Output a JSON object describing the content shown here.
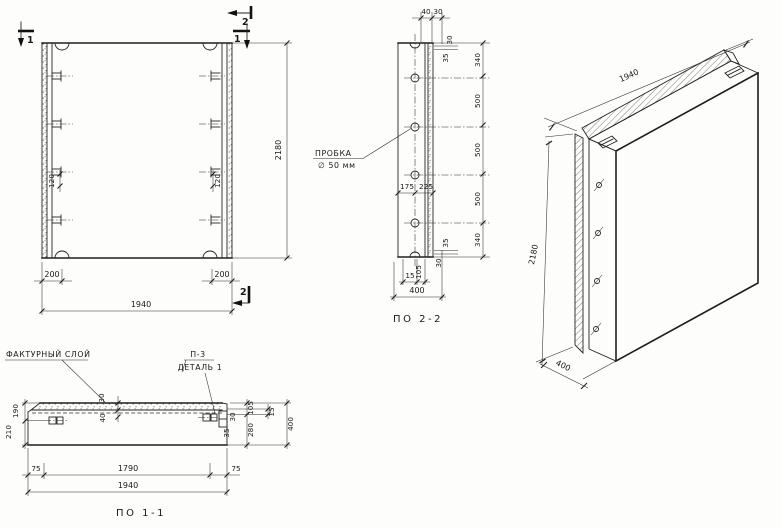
{
  "front_view": {
    "marker_1_top_left": "1",
    "marker_2_top_right": "2",
    "marker_1_top_right": "1",
    "marker_2_bottom": "2",
    "dim_anchor_left": "120",
    "dim_anchor_right": "120",
    "dim_height": "2180",
    "dim_edge_left": "200",
    "dim_edge_right": "200",
    "dim_width": "1940"
  },
  "section_2_2": {
    "caption": "ПО 2-2",
    "plug_label_line1": "ПРОБКА",
    "plug_label_line2": "∅ 50 мм",
    "dim_top_40": "40",
    "dim_top_30": "30",
    "dim_right_top_30": "30",
    "dim_right_top_35": "35",
    "chain": [
      "340",
      "500",
      "500",
      "500",
      "340"
    ],
    "dim_right_bottom_35": "35",
    "dim_right_bottom_30": "30",
    "dim_mid_left": "175",
    "dim_mid_right": "225",
    "dim_bottom_15": "15",
    "dim_bottom_105": "105",
    "dim_width": "400"
  },
  "iso_view": {
    "dim_width": "1940",
    "dim_height": "2180",
    "dim_depth": "400"
  },
  "section_1_1": {
    "caption": "ПО 1-1",
    "label_facing_layer": "ФАКТУРНЫЙ СЛОЙ",
    "label_detail_line1": "П-3",
    "label_detail_line2": "ДЕТАЛЬ 1",
    "dim_top_30": "30",
    "dim_top_40": "40",
    "dim_left_190": "190",
    "dim_left_210": "210",
    "dim_right_105": "105",
    "dim_right_15": "15",
    "dim_right_280": "280",
    "dim_right_400": "400",
    "dim_detail_30": "30",
    "dim_detail_35": "35",
    "dim_bottom_75_left": "75",
    "dim_bottom_1790": "1790",
    "dim_bottom_75_right": "75",
    "dim_bottom_1940": "1940"
  }
}
